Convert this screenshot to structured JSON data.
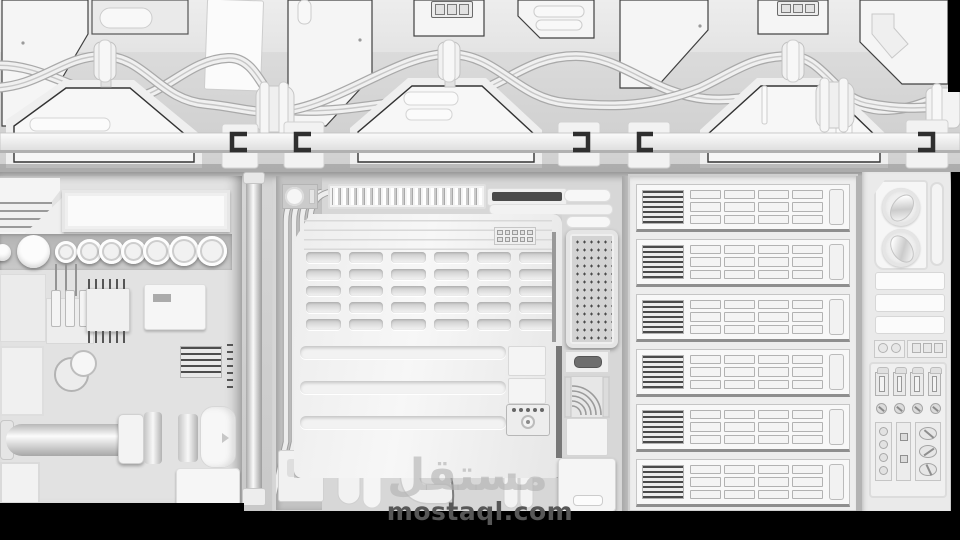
{
  "scene": {
    "description": "Grayscale ambient-occlusion 3D render of a sci-fi greeble wall: door panels and braided cables on top, machinery consoles, a six-row server rack and gauge/switch panels below",
    "background_color": "#000000"
  },
  "palette": {
    "panel_white": "#f6f6f6",
    "panel_light": "#ececec",
    "wall_gray": "#d6d6d6",
    "strip_gray": "#bfbfbf",
    "outline_dark": "#3a3a3a",
    "stripe_dark": "#4a4a4a",
    "black": "#000000"
  },
  "watermark": {
    "logo_text": "مستقل",
    "site_text": "mostaql.com",
    "logo_color": "rgba(178,178,178,0.62)",
    "site_color": "#575757"
  },
  "top_wall": {
    "door_panel_count": 9,
    "hatch_count": 3,
    "cable_bundle_count": 2,
    "pipe_clamp_count": 3,
    "ring_clamp_count": 2,
    "rail_bracket_count": 5,
    "connector_square_count": 3
  },
  "left_console": {
    "dial_count": 9,
    "wire_count": 3,
    "plug_count": 3,
    "heatsink_stripe_count": 7
  },
  "center_console": {
    "slat_count": 19,
    "dip_switch_count": 10,
    "vent_slot_count": 30,
    "vent_columns": 6,
    "groove_count": 3,
    "control_dot_count": 5,
    "pipe_count": 4,
    "hanging_tube_count": 5
  },
  "server_rack": {
    "row_count": 6,
    "tray_cell_count": 12,
    "tray_columns": 4,
    "vent_stripe_count": 7
  },
  "right_console": {
    "gauge_count": 2,
    "bar_count": 3,
    "key_switch_count": 4,
    "screw_count": 4,
    "side_screw_count": 4,
    "mid_square_count": 2,
    "oval_knob_count": 3,
    "mini_circle_count": 2,
    "mini_square_count": 3
  }
}
